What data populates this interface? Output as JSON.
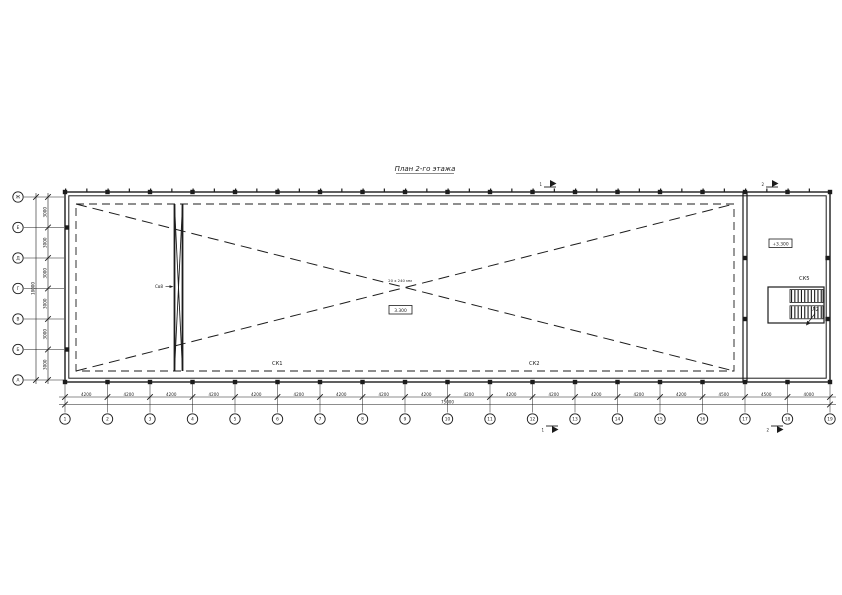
{
  "title": "План 2-го этажа",
  "grid": {
    "bottom_bubbles": [
      "1",
      "2",
      "3",
      "4",
      "5",
      "6",
      "7",
      "8",
      "9",
      "10",
      "11",
      "12",
      "13",
      "14",
      "15",
      "16",
      "17",
      "18",
      "19"
    ],
    "bottom_dims": [
      "4200",
      "4200",
      "4200",
      "4200",
      "4200",
      "4200",
      "4200",
      "4200",
      "4200",
      "4200",
      "4200",
      "4200",
      "4200",
      "4200",
      "4200",
      "4500",
      "4500",
      "4000"
    ],
    "bottom_total": "75000",
    "left_bubbles": [
      "Ж",
      "Е",
      "Д",
      "Г",
      "В",
      "Б",
      "А"
    ],
    "left_dims": [
      "3000",
      "3000",
      "3000",
      "3000",
      "3000",
      "3000"
    ],
    "left_total": "18000"
  },
  "annotations": {
    "truss1": "СК1",
    "truss2": "СК2",
    "truss5": "СК5",
    "brace": "Св8",
    "stair": "Л2",
    "center_note": "20 х 240 мм",
    "center_elevation": "3.300",
    "stair_elevation": "+3.300",
    "section_left": "1",
    "section_right": "2"
  },
  "colors": {
    "ink": "#1c1c1c",
    "paper": "#ffffff"
  }
}
